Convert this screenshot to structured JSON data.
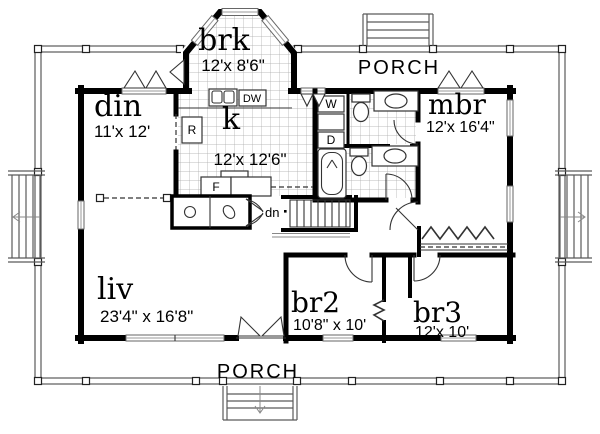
{
  "plan": {
    "porch_top_label": "PORCH",
    "porch_bottom_label": "PORCH",
    "stairs_direction_label": "dn",
    "rooms": [
      {
        "id": "brk",
        "label": "brk",
        "dims": "12'x 8'6\""
      },
      {
        "id": "din",
        "label": "din",
        "dims": "11'x 12'"
      },
      {
        "id": "kitchen",
        "label": "k",
        "dims": "12'x 12'6\""
      },
      {
        "id": "mbr",
        "label": "mbr",
        "dims": "12'x 16'4\""
      },
      {
        "id": "liv",
        "label": "liv",
        "dims": "23'4\" x 16'8\""
      },
      {
        "id": "br2",
        "label": "br2",
        "dims": "10'8\" x 10'"
      },
      {
        "id": "br3",
        "label": "br3",
        "dims": "12'x 10'"
      }
    ],
    "fixtures": {
      "dishwasher_label": "DW",
      "washer_label": "W",
      "dryer_label": "D",
      "refrigerator_label": "R",
      "furnace_label": "F"
    },
    "colors": {
      "wall": "#000000",
      "thin_line": "#333333",
      "tile_grid": "#a0a0a0",
      "background": "#ffffff"
    }
  }
}
